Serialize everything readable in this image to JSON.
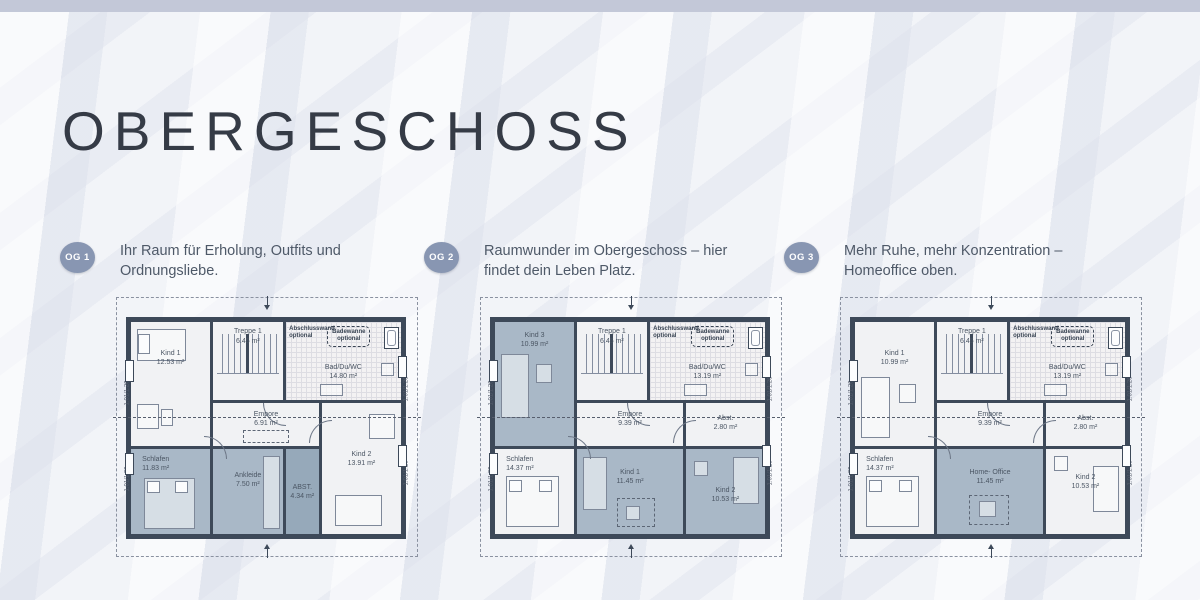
{
  "page": {
    "title": "OBERGESCHOSS"
  },
  "theme": {
    "topbar_color": "#c3c8d8",
    "background_color": "#edeff5",
    "badge_color": "#8896b2",
    "wall_color": "#3d4959",
    "shaded_room_color": "#a9b8c7",
    "text_color": "#4e5968"
  },
  "variants": [
    {
      "badge": "OG 1",
      "description": "Ihr Raum für Erholung, Outfits und Ordnungsliebe.",
      "window_dim": "1.01/1.26",
      "annotations": {
        "abschlusswand": "Abschlusswand optional",
        "badewanne": "Badewanne optional"
      },
      "rooms": {
        "kind1": {
          "name": "Kind 1",
          "area": "12.53 m²"
        },
        "treppe": {
          "name": "Treppe 1",
          "area": "6.45 m²"
        },
        "bad": {
          "name": "Bad/Du/WC",
          "area": "14.80 m²"
        },
        "empore": {
          "name": "Empore",
          "area": "6.91 m²"
        },
        "schlafen": {
          "name": "Schlafen",
          "area": "11.83 m²"
        },
        "ankleide": {
          "name": "Ankleide",
          "area": "7.50 m²"
        },
        "abst": {
          "name": "ABST.",
          "area": "4.34 m²"
        },
        "kind2": {
          "name": "Kind 2",
          "area": "13.91 m²"
        }
      }
    },
    {
      "badge": "OG 2",
      "description": "Raumwunder im Obergeschoss – hier findet dein Leben Platz.",
      "window_dim": "1.01/1.26",
      "annotations": {
        "abschlusswand": "Abschlusswand optional",
        "badewanne": "Badewanne optional"
      },
      "rooms": {
        "kind3": {
          "name": "Kind 3",
          "area": "10.99 m²"
        },
        "treppe": {
          "name": "Treppe 1",
          "area": "6.45 m²"
        },
        "bad": {
          "name": "Bad/Du/WC",
          "area": "13.19 m²"
        },
        "empore": {
          "name": "Empore",
          "area": "9.39 m²"
        },
        "abst": {
          "name": "Abst.",
          "area": "2.80 m²"
        },
        "schlafen": {
          "name": "Schlafen",
          "area": "14.37 m²"
        },
        "kind1b": {
          "name": "Kind 1",
          "area": "11.45 m²"
        },
        "kind2": {
          "name": "Kind 2",
          "area": "10.53 m²"
        }
      }
    },
    {
      "badge": "OG 3",
      "description": "Mehr Ruhe, mehr Konzentration – Homeoffice oben.",
      "window_dim": "1.01/1.26",
      "annotations": {
        "abschlusswand": "Abschlusswand optional",
        "badewanne": "Badewanne optional"
      },
      "rooms": {
        "kind1": {
          "name": "Kind 1",
          "area": "10.99 m²"
        },
        "treppe": {
          "name": "Treppe 1",
          "area": "6.45 m²"
        },
        "bad": {
          "name": "Bad/Du/WC",
          "area": "13.19 m²"
        },
        "empore": {
          "name": "Empore",
          "area": "9.39 m²"
        },
        "abst": {
          "name": "Abst.",
          "area": "2.80 m²"
        },
        "schlafen": {
          "name": "Schlafen",
          "area": "14.37 m²"
        },
        "home": {
          "name": "Home- Office",
          "area": "11.45 m²"
        },
        "kind2": {
          "name": "Kind 2",
          "area": "10.53 m²"
        }
      }
    }
  ]
}
